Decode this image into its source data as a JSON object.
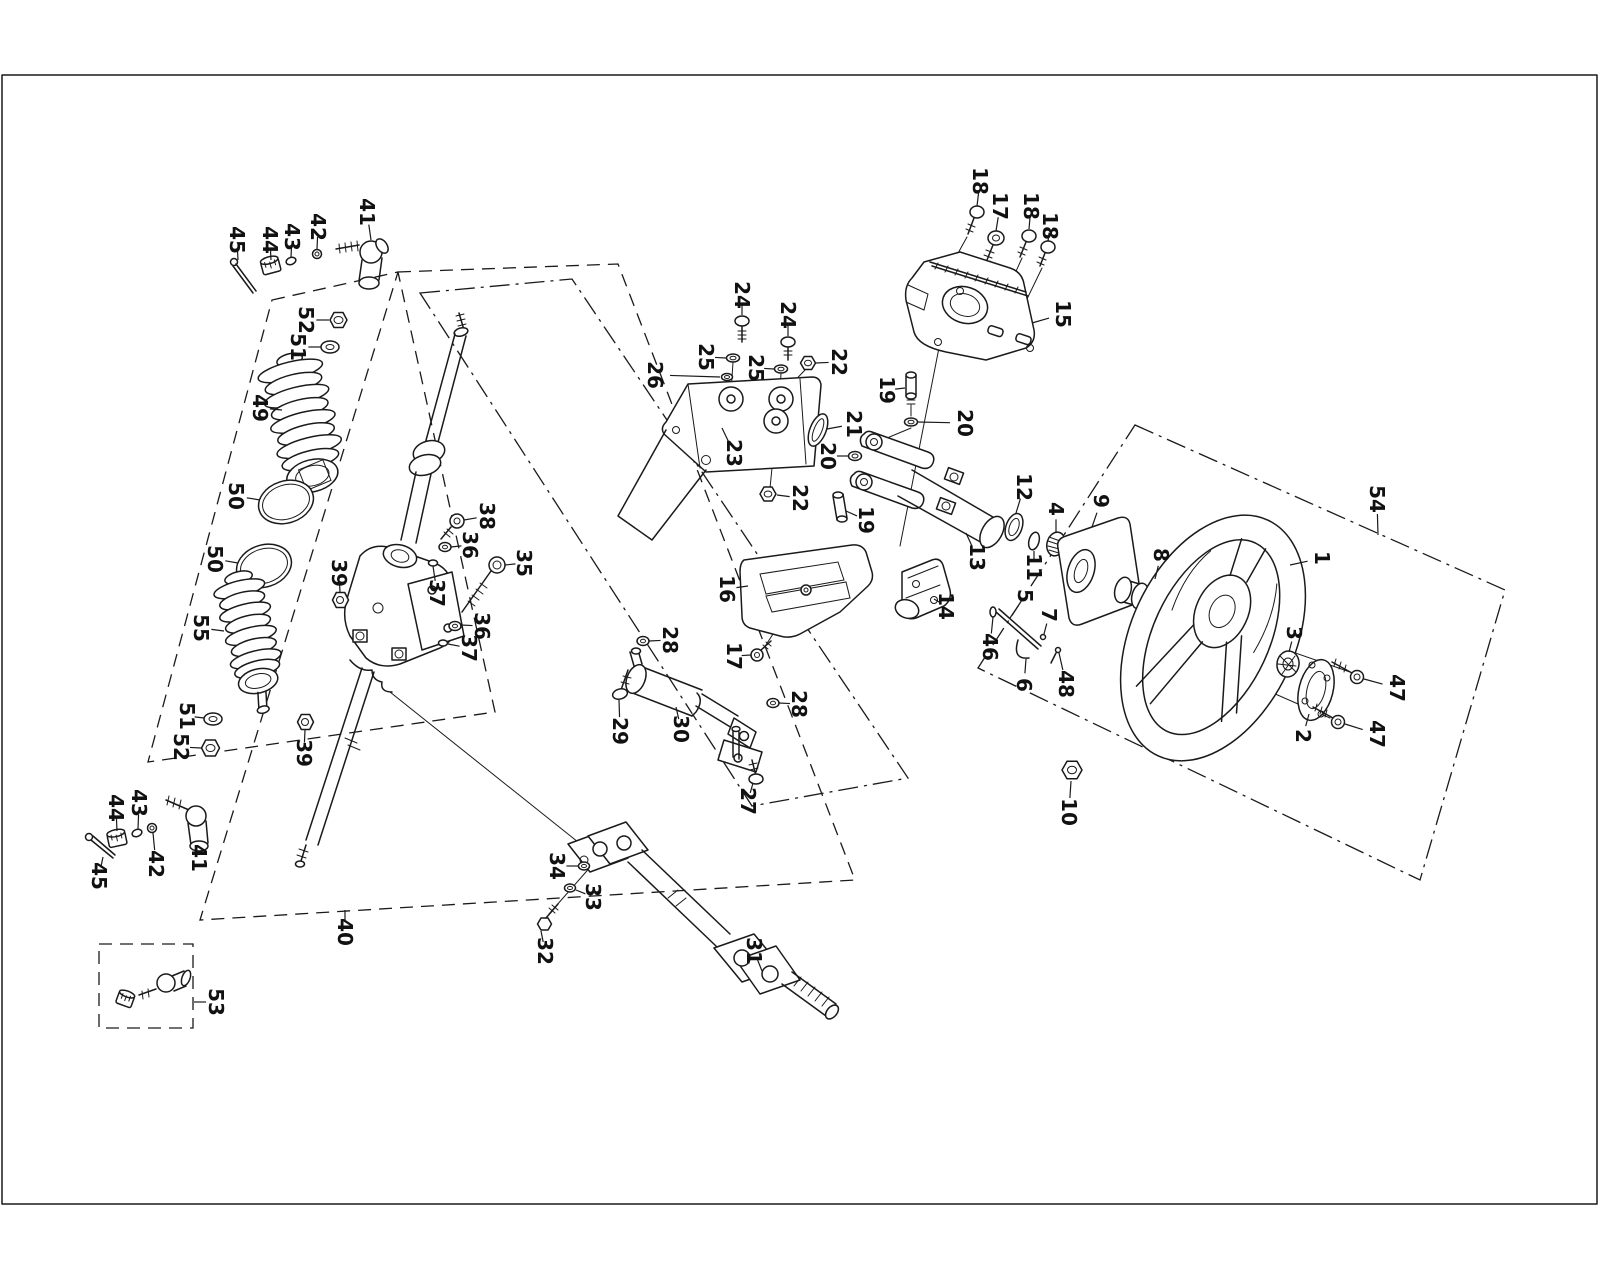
{
  "diagram": {
    "kind": "exploded-parts-diagram",
    "background": "#ffffff",
    "line_color": "#1a1a1a",
    "label_color": "#111111",
    "label_font_size_px": 20,
    "label_rotation_deg": 90,
    "border": {
      "x": 2,
      "y": 75,
      "width": 1595,
      "height": 1129
    },
    "parts": [
      {
        "num": "1",
        "x": 1322,
        "y": 558,
        "tx": 1290,
        "ty": 565
      },
      {
        "num": "2",
        "x": 1303,
        "y": 736,
        "tx": 1309,
        "ty": 714
      },
      {
        "num": "3",
        "x": 1294,
        "y": 633,
        "tx": 1289,
        "ty": 652
      },
      {
        "num": "4",
        "x": 1056,
        "y": 509,
        "tx": 1056,
        "ty": 532
      },
      {
        "num": "5",
        "x": 1025,
        "y": 596,
        "tx": 1010,
        "ty": 618
      },
      {
        "num": "6",
        "x": 1024,
        "y": 685,
        "tx": 1026,
        "ty": 659
      },
      {
        "num": "7",
        "x": 1049,
        "y": 615,
        "tx": 1044,
        "ty": 634
      },
      {
        "num": "8",
        "x": 1161,
        "y": 555,
        "tx": 1155,
        "ty": 579
      },
      {
        "num": "9",
        "x": 1101,
        "y": 501,
        "tx": 1092,
        "ty": 527
      },
      {
        "num": "10",
        "x": 1069,
        "y": 812,
        "tx": 1071,
        "ty": 781
      },
      {
        "num": "11",
        "x": 1034,
        "y": 567,
        "tx": 1034,
        "ty": 551
      },
      {
        "num": "12",
        "x": 1024,
        "y": 487,
        "tx": 1016,
        "ty": 513
      },
      {
        "num": "13",
        "x": 977,
        "y": 557,
        "tx": 966,
        "ty": 533
      },
      {
        "num": "14",
        "x": 946,
        "y": 606,
        "tx": 934,
        "ty": 599
      },
      {
        "num": "15",
        "x": 1063,
        "y": 314,
        "tx": 1032,
        "ty": 323
      },
      {
        "num": "16",
        "x": 727,
        "y": 589,
        "tx": 748,
        "ty": 586
      },
      {
        "num": "17",
        "x": 1000,
        "y": 206,
        "tx": 996,
        "ty": 231
      },
      {
        "num": "17",
        "x": 734,
        "y": 656,
        "tx": 751,
        "ty": 655
      },
      {
        "num": "18",
        "x": 980,
        "y": 181,
        "tx": 977,
        "ty": 206
      },
      {
        "num": "18",
        "x": 1031,
        "y": 206,
        "tx": 1029,
        "ty": 229
      },
      {
        "num": "18",
        "x": 1050,
        "y": 226,
        "tx": 1048,
        "ty": 241
      },
      {
        "num": "19",
        "x": 887,
        "y": 390,
        "tx": 905,
        "ty": 388
      },
      {
        "num": "19",
        "x": 866,
        "y": 520,
        "tx": 846,
        "ty": 511
      },
      {
        "num": "20",
        "x": 965,
        "y": 423,
        "tx": 918,
        "ty": 422
      },
      {
        "num": "20",
        "x": 828,
        "y": 456,
        "tx": 848,
        "ty": 456
      },
      {
        "num": "21",
        "x": 854,
        "y": 424,
        "tx": 827,
        "ty": 429
      },
      {
        "num": "22",
        "x": 839,
        "y": 362,
        "tx": 816,
        "ty": 363
      },
      {
        "num": "22",
        "x": 800,
        "y": 498,
        "tx": 777,
        "ty": 495
      },
      {
        "num": "23",
        "x": 734,
        "y": 453,
        "tx": 722,
        "ty": 428
      },
      {
        "num": "24",
        "x": 742,
        "y": 295,
        "tx": 742,
        "ty": 315
      },
      {
        "num": "24",
        "x": 788,
        "y": 315,
        "tx": 788,
        "ty": 336
      },
      {
        "num": "25",
        "x": 706,
        "y": 357,
        "tx": 726,
        "ty": 358
      },
      {
        "num": "25",
        "x": 756,
        "y": 368,
        "tx": 774,
        "ty": 369
      },
      {
        "num": "26",
        "x": 655,
        "y": 375,
        "tx": 720,
        "ty": 377
      },
      {
        "num": "27",
        "x": 748,
        "y": 801,
        "tx": 753,
        "ty": 783
      },
      {
        "num": "28",
        "x": 670,
        "y": 640,
        "tx": 649,
        "ty": 641
      },
      {
        "num": "28",
        "x": 799,
        "y": 704,
        "tx": 779,
        "ty": 703
      },
      {
        "num": "29",
        "x": 620,
        "y": 731,
        "tx": 619,
        "ty": 700
      },
      {
        "num": "30",
        "x": 681,
        "y": 729,
        "tx": 676,
        "ty": 707
      },
      {
        "num": "31",
        "x": 754,
        "y": 951,
        "tx": 762,
        "ty": 971
      },
      {
        "num": "32",
        "x": 545,
        "y": 951,
        "tx": 541,
        "ty": 931
      },
      {
        "num": "33",
        "x": 593,
        "y": 897,
        "tx": 576,
        "ty": 890
      },
      {
        "num": "34",
        "x": 557,
        "y": 866,
        "tx": 578,
        "ty": 866
      },
      {
        "num": "35",
        "x": 524,
        "y": 563,
        "tx": 505,
        "ty": 565
      },
      {
        "num": "36",
        "x": 470,
        "y": 545,
        "tx": 451,
        "ty": 547
      },
      {
        "num": "36",
        "x": 482,
        "y": 626,
        "tx": 461,
        "ty": 625
      },
      {
        "num": "37",
        "x": 437,
        "y": 593,
        "tx": 433,
        "ty": 566
      },
      {
        "num": "37",
        "x": 469,
        "y": 648,
        "tx": 448,
        "ty": 644
      },
      {
        "num": "38",
        "x": 487,
        "y": 516,
        "tx": 464,
        "ty": 520
      },
      {
        "num": "39",
        "x": 339,
        "y": 573,
        "tx": 340,
        "ty": 592
      },
      {
        "num": "39",
        "x": 304,
        "y": 753,
        "tx": 305,
        "ty": 730
      },
      {
        "num": "40",
        "x": 345,
        "y": 932,
        "tx": 345,
        "ty": 910
      },
      {
        "num": "41",
        "x": 367,
        "y": 212,
        "tx": 371,
        "ty": 240
      },
      {
        "num": "41",
        "x": 199,
        "y": 858,
        "tx": 198,
        "ty": 851
      },
      {
        "num": "42",
        "x": 318,
        "y": 227,
        "tx": 317,
        "ty": 249
      },
      {
        "num": "42",
        "x": 156,
        "y": 864,
        "tx": 153,
        "ty": 833
      },
      {
        "num": "43",
        "x": 292,
        "y": 237,
        "tx": 291,
        "ty": 257
      },
      {
        "num": "43",
        "x": 139,
        "y": 803,
        "tx": 138,
        "ty": 829
      },
      {
        "num": "44",
        "x": 270,
        "y": 240,
        "tx": 271,
        "ty": 260
      },
      {
        "num": "44",
        "x": 116,
        "y": 808,
        "tx": 117,
        "ty": 831
      },
      {
        "num": "45",
        "x": 237,
        "y": 240,
        "tx": 238,
        "ty": 260
      },
      {
        "num": "45",
        "x": 99,
        "y": 876,
        "tx": 103,
        "ty": 857
      },
      {
        "num": "46",
        "x": 990,
        "y": 647,
        "tx": 993,
        "ty": 617
      },
      {
        "num": "47",
        "x": 1397,
        "y": 688,
        "tx": 1364,
        "ty": 679
      },
      {
        "num": "47",
        "x": 1377,
        "y": 734,
        "tx": 1345,
        "ty": 724
      },
      {
        "num": "48",
        "x": 1066,
        "y": 684,
        "tx": 1059,
        "ty": 653
      },
      {
        "num": "49",
        "x": 260,
        "y": 408,
        "tx": 282,
        "ty": 410
      },
      {
        "num": "50",
        "x": 236,
        "y": 496,
        "tx": 260,
        "ty": 500
      },
      {
        "num": "50",
        "x": 215,
        "y": 559,
        "tx": 238,
        "ty": 563
      },
      {
        "num": "51",
        "x": 298,
        "y": 347,
        "tx": 321,
        "ty": 347
      },
      {
        "num": "51",
        "x": 187,
        "y": 716,
        "tx": 204,
        "ty": 718
      },
      {
        "num": "52",
        "x": 306,
        "y": 320,
        "tx": 329,
        "ty": 320
      },
      {
        "num": "52",
        "x": 181,
        "y": 747,
        "tx": 201,
        "ty": 748
      },
      {
        "num": "53",
        "x": 216,
        "y": 1002,
        "tx": 194,
        "ty": 1002
      },
      {
        "num": "54",
        "x": 1377,
        "y": 499,
        "tx": 1378,
        "ty": 535
      },
      {
        "num": "55",
        "x": 201,
        "y": 628,
        "tx": 224,
        "ty": 631
      }
    ]
  }
}
